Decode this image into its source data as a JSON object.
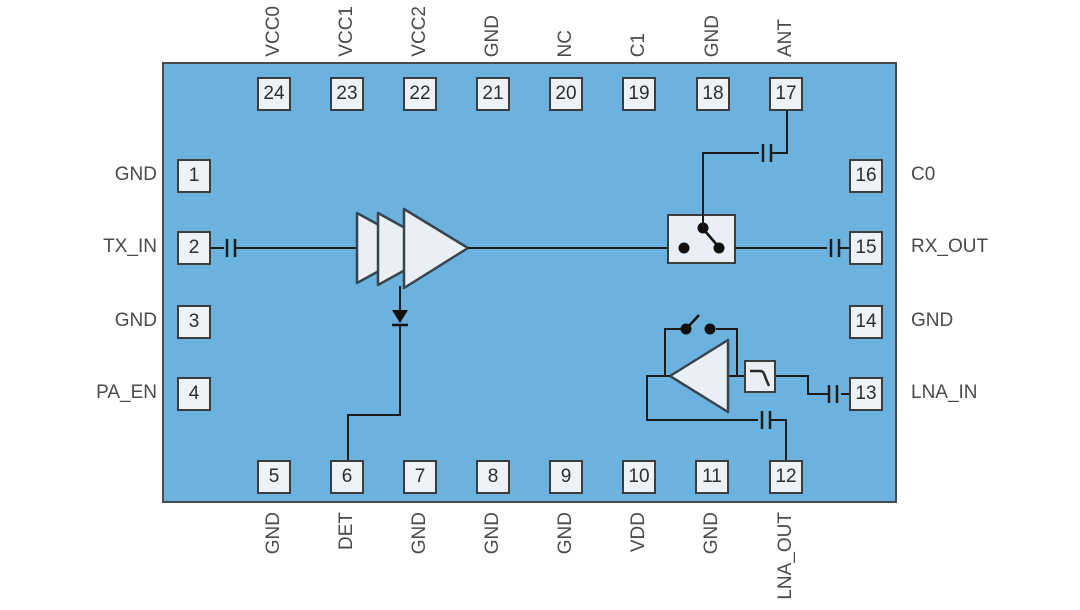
{
  "colors": {
    "chip_fill": "#6BB2DE",
    "chip_border": "#4A4A4A",
    "pin_box_fill": "#EDF2F7",
    "pin_box_border": "#3D3D3D",
    "wire": "#1C1C1C",
    "symbol_fill": "#E9EFF5",
    "symbol_stroke": "#39444C",
    "label_text": "#4A4A4A"
  },
  "icons": {
    "pa_amplifier": "three-stage-amplifier-icon",
    "detector_diode": "diode-icon",
    "antenna_switch": "spdt-switch-icon",
    "lna_amplifier": "amplifier-icon",
    "bypass_switch": "switch-icon",
    "filter": "low-pass-filter-icon",
    "dc_block": "capacitor-icon"
  },
  "pins": {
    "top": [
      {
        "number": "24",
        "label": "VCC0"
      },
      {
        "number": "23",
        "label": "VCC1"
      },
      {
        "number": "22",
        "label": "VCC2"
      },
      {
        "number": "21",
        "label": "GND"
      },
      {
        "number": "20",
        "label": "NC"
      },
      {
        "number": "19",
        "label": "C1"
      },
      {
        "number": "18",
        "label": "GND"
      },
      {
        "number": "17",
        "label": "ANT"
      }
    ],
    "bottom": [
      {
        "number": "5",
        "label": "GND"
      },
      {
        "number": "6",
        "label": "DET"
      },
      {
        "number": "7",
        "label": "GND"
      },
      {
        "number": "8",
        "label": "GND"
      },
      {
        "number": "9",
        "label": "GND"
      },
      {
        "number": "10",
        "label": "VDD"
      },
      {
        "number": "11",
        "label": "GND"
      },
      {
        "number": "12",
        "label": "LNA_OUT"
      }
    ],
    "left": [
      {
        "number": "1",
        "label": "GND"
      },
      {
        "number": "2",
        "label": "TX_IN"
      },
      {
        "number": "3",
        "label": "GND"
      },
      {
        "number": "4",
        "label": "PA_EN"
      }
    ],
    "right": [
      {
        "number": "16",
        "label": "C0"
      },
      {
        "number": "15",
        "label": "RX_OUT"
      },
      {
        "number": "14",
        "label": "GND"
      },
      {
        "number": "13",
        "label": "LNA_IN"
      }
    ]
  }
}
